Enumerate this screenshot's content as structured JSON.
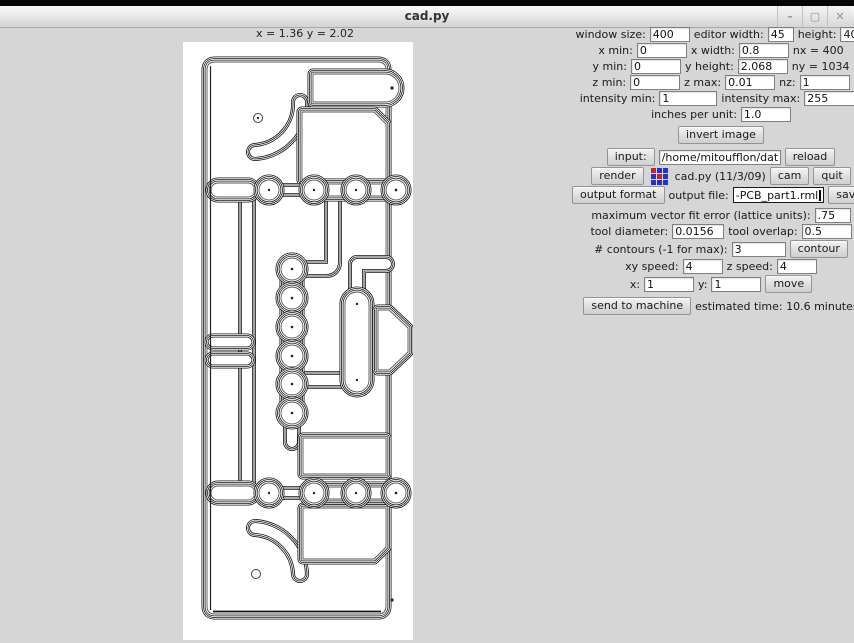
{
  "window": {
    "title": "cad.py",
    "controls": {
      "minimize": "–",
      "maximize": "▢",
      "close": "✕"
    }
  },
  "canvas": {
    "coords": "x = 1.36  y = 2.02"
  },
  "logo": {
    "cells": [
      "#cc2222",
      "#2233cc",
      "#2233cc",
      "#2233cc",
      "#cc2222",
      "#2233cc",
      "#2233cc",
      "#2233cc",
      "#2233cc"
    ]
  },
  "colors": {
    "background": "#d6d6d6",
    "canvas": "#ffffff",
    "line": "#111111"
  },
  "fields": {
    "window_size": {
      "label": "window size:",
      "value": "400"
    },
    "editor_width": {
      "label": "editor width:",
      "value": "45"
    },
    "height": {
      "label": "height:",
      "value": "40"
    },
    "x_min": {
      "label": "x min:",
      "value": "0"
    },
    "x_width": {
      "label": "x width:",
      "value": "0.8"
    },
    "nx": {
      "label": "nx = 400"
    },
    "y_min": {
      "label": "y min:",
      "value": "0"
    },
    "y_height": {
      "label": "y height:",
      "value": "2.068"
    },
    "ny": {
      "label": "ny = 1034"
    },
    "z_min": {
      "label": "z min:",
      "value": "0"
    },
    "z_max": {
      "label": "z max:",
      "value": "0.01"
    },
    "nz": {
      "label": "nz:",
      "value": "1"
    },
    "intensity_min": {
      "label": "intensity min:",
      "value": "1"
    },
    "intensity_max": {
      "label": "intensity max:",
      "value": "255"
    },
    "inches_per_unit": {
      "label": "inches per unit:",
      "value": "1.0"
    },
    "invert_button": "invert image",
    "input": {
      "button": "input:",
      "value": "/home/mitoufflon/data/",
      "reload": "reload"
    },
    "render_row": {
      "render": "render",
      "app_label": "cad.py (11/3/09)",
      "cam": "cam",
      "quit": "quit"
    },
    "output": {
      "format_button": "output format",
      "label": "output file:",
      "value": "-PCB_part1.rml",
      "save": "save"
    },
    "vector_fit": {
      "label": "maximum vector fit error (lattice units):",
      "value": ".75"
    },
    "tool_diameter": {
      "label": "tool diameter:",
      "value": "0.0156"
    },
    "tool_overlap": {
      "label": "tool overlap:",
      "value": "0.5"
    },
    "contours": {
      "label": "# contours (-1 for max):",
      "value": "3",
      "button": "contour"
    },
    "xy_speed": {
      "label": "xy speed:",
      "value": "4"
    },
    "z_speed": {
      "label": "z speed:",
      "value": "4"
    },
    "x": {
      "label": "x:",
      "value": "1"
    },
    "y": {
      "label": "y:",
      "value": "1"
    },
    "move_button": "move",
    "send_button": "send to machine",
    "estimated": "estimated time: 10.6 minutes"
  }
}
